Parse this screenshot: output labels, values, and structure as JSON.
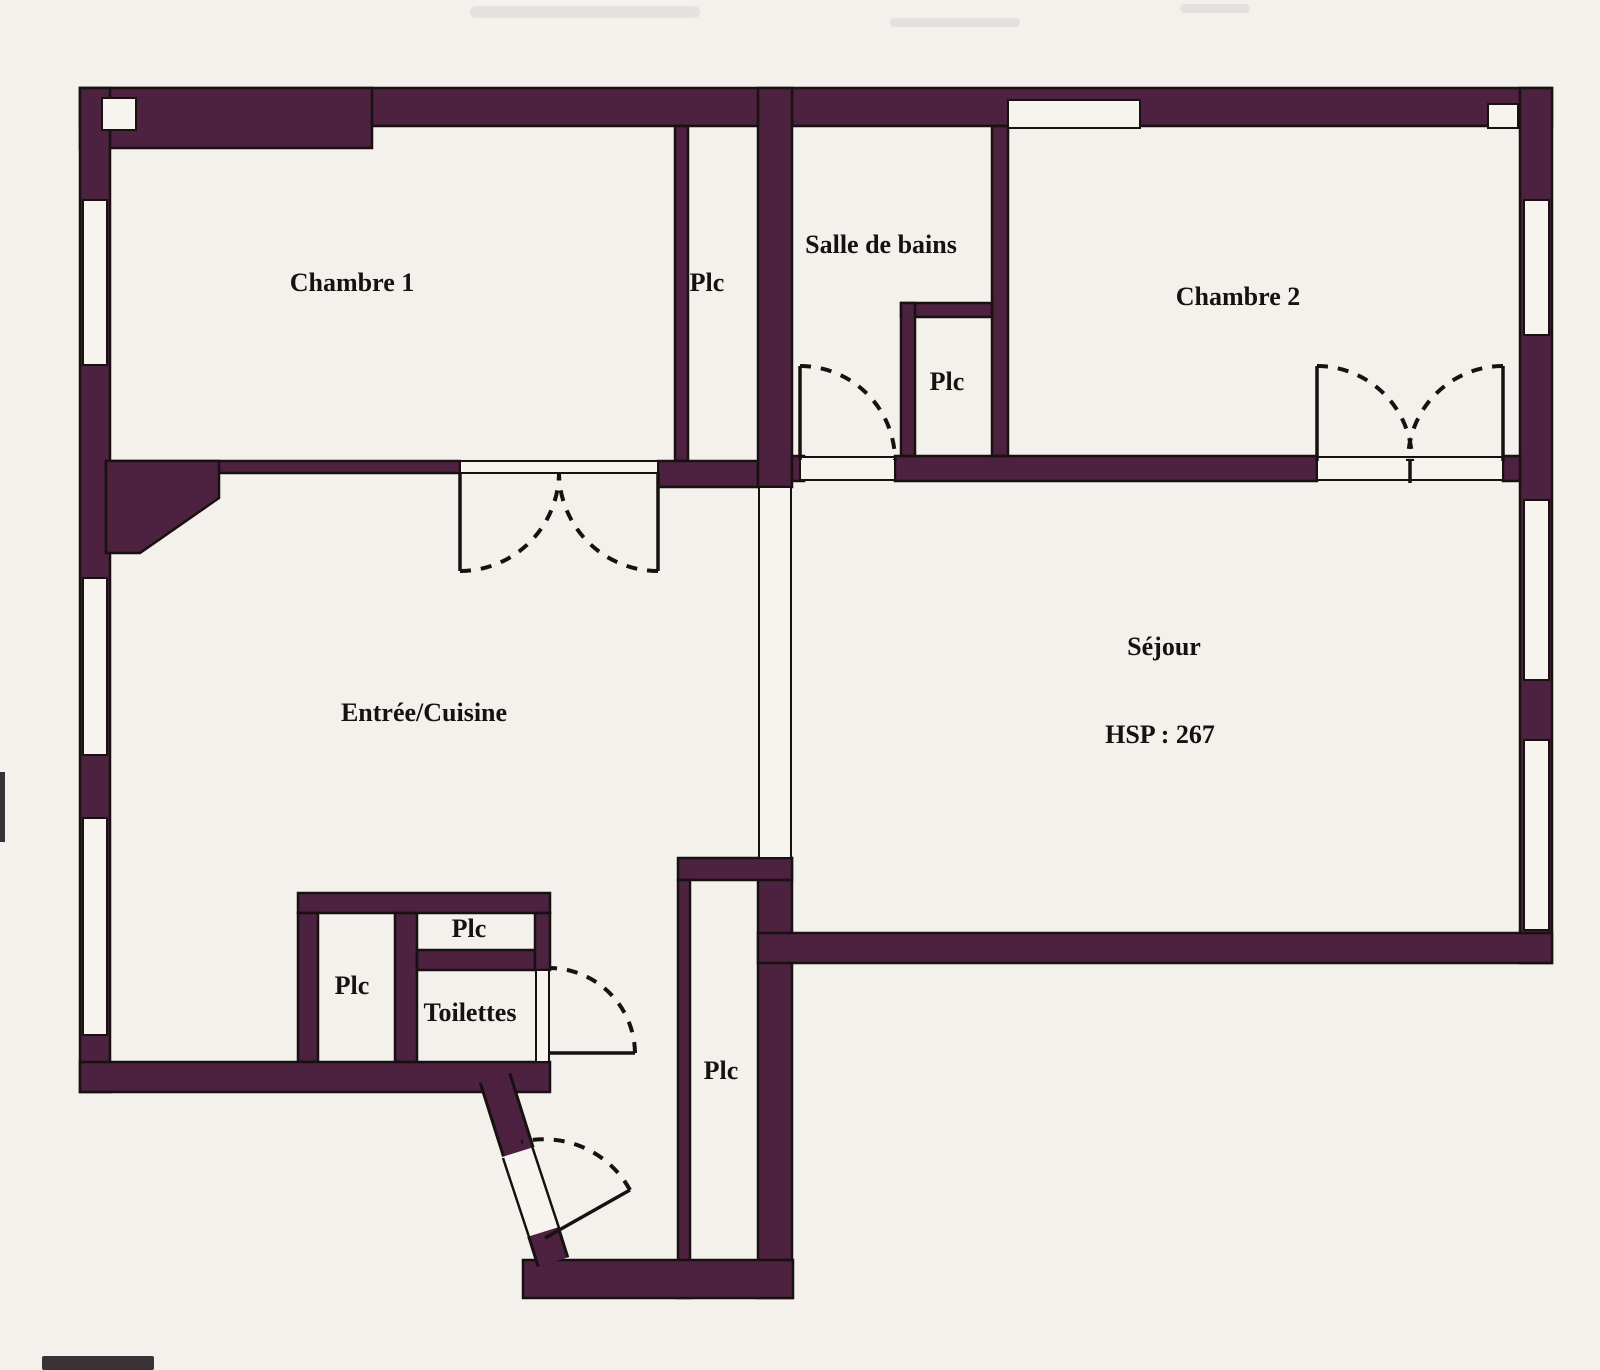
{
  "plan": {
    "type": "apartment-floor-plan",
    "labels": {
      "chambre1": "Chambre 1",
      "plc_couloir_haut": "Plc",
      "salle_de_bains": "Salle de bains",
      "plc_salle_de_bains": "Plc",
      "chambre2": "Chambre 2",
      "sejour": "Séjour",
      "sejour_hsp": "HSP : 267",
      "entree_cuisine": "Entrée/Cuisine",
      "plc_entree_gauche": "Plc",
      "plc_entree_haut": "Plc",
      "toilettes": "Toilettes",
      "plc_couloir_bas": "Plc"
    },
    "colors": {
      "wall": "#4d2140",
      "line": "#17110f",
      "paper": "#f7f4f0",
      "page": "#f4f1ed"
    }
  }
}
